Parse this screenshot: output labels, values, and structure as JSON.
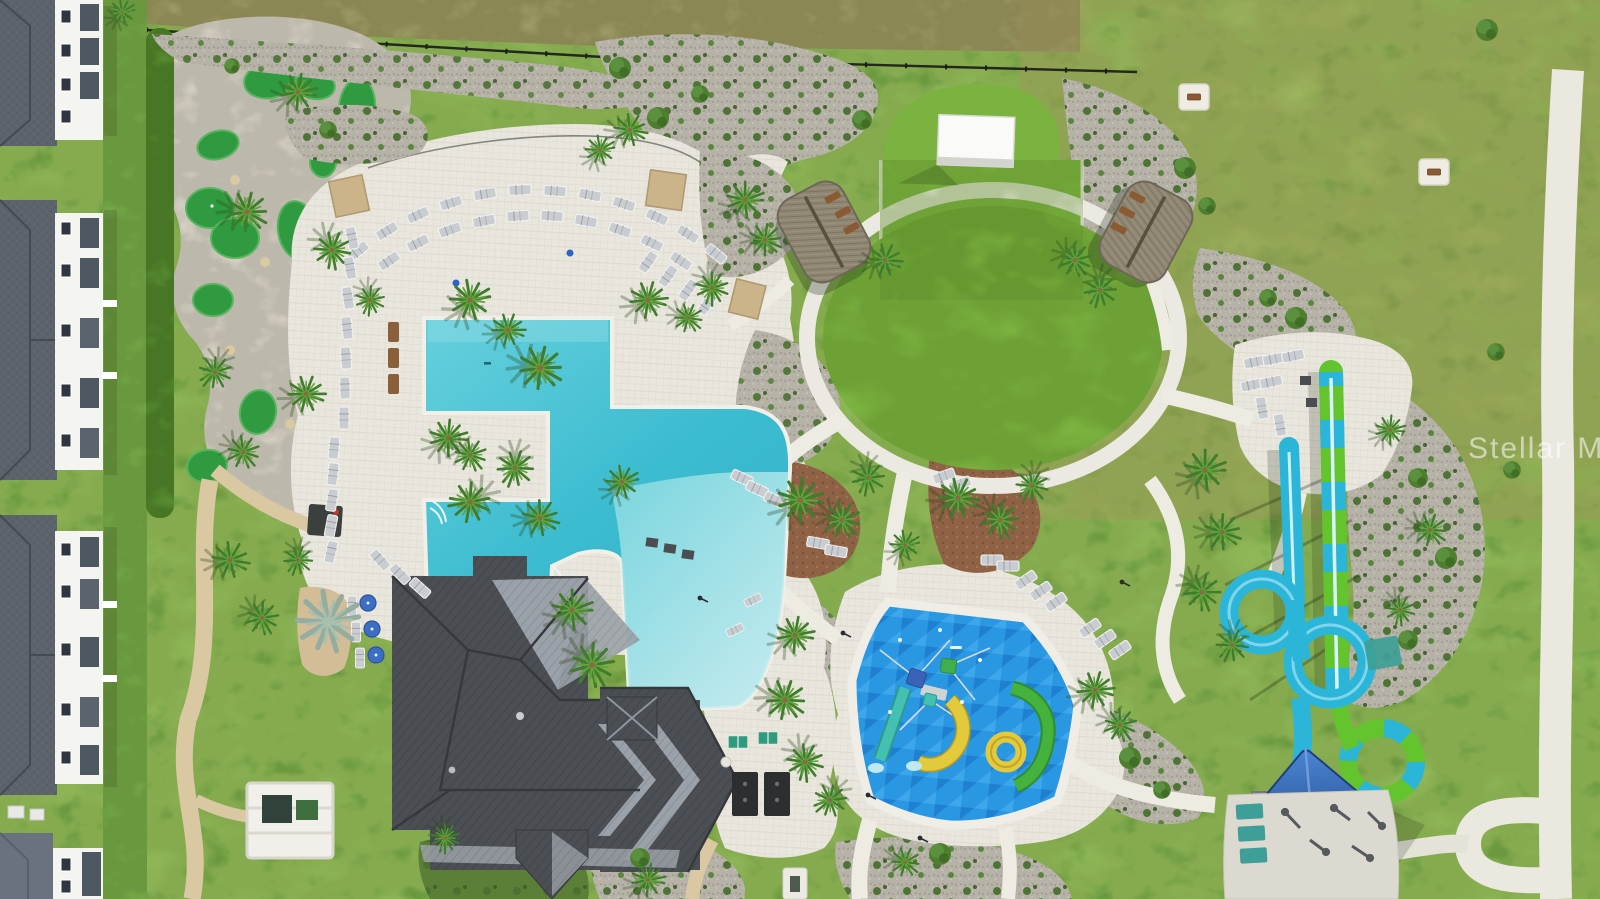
{
  "photo": {
    "type": "aerial-drone-photo",
    "subject": "resort-style community amenity campus with pool, splash pad, water slides, event lawn, mini golf and clubhouse",
    "watermark_text": "Stellar MLS"
  },
  "palette": {
    "grass": "#7aab4c",
    "lawn_circle": "#7cb340",
    "field": "#8db257",
    "weedy_field": "#9b9a64",
    "deck": "#e9e6dd",
    "concrete": "#edebe2",
    "sand_path": "#dac8a2",
    "gravel": "#b6b2a8",
    "mulch": "#8f6246",
    "hedge": "#578a31",
    "putting_green": "#2f9a3f",
    "pool_water": "#41c2d5",
    "pool_shallow": "#c9edf0",
    "pool_rim": "#f1efe7",
    "splash_pad": "#2a97e2",
    "splash_yellow": "#e3c93c",
    "splash_green": "#46b23e",
    "splash_teal": "#43c0b2",
    "slide_blue": "#2ab5d9",
    "slide_green": "#64c42d",
    "roof_dark": "#4b4e53",
    "roof_light": "#9ba1a8",
    "apartment_roof": "#5d636c",
    "wall_white": "#f4f4f1",
    "thatch": "#8f8774",
    "screen": "#fafaf8",
    "canopy_blue": "#2f6abc",
    "umbrella_blue": "#3d6ec5",
    "fence": "#24271f",
    "watermark": "rgba(255,255,255,0.55)"
  },
  "features": [
    {
      "name": "apartment-buildings"
    },
    {
      "name": "mini-golf-course"
    },
    {
      "name": "resort-pool"
    },
    {
      "name": "pool-deck"
    },
    {
      "name": "event-lawn"
    },
    {
      "name": "outdoor-movie-screen"
    },
    {
      "name": "tiki-huts"
    },
    {
      "name": "splash-pad"
    },
    {
      "name": "water-slides"
    },
    {
      "name": "clubhouse"
    },
    {
      "name": "fitness-zone"
    },
    {
      "name": "walking-paths"
    }
  ]
}
